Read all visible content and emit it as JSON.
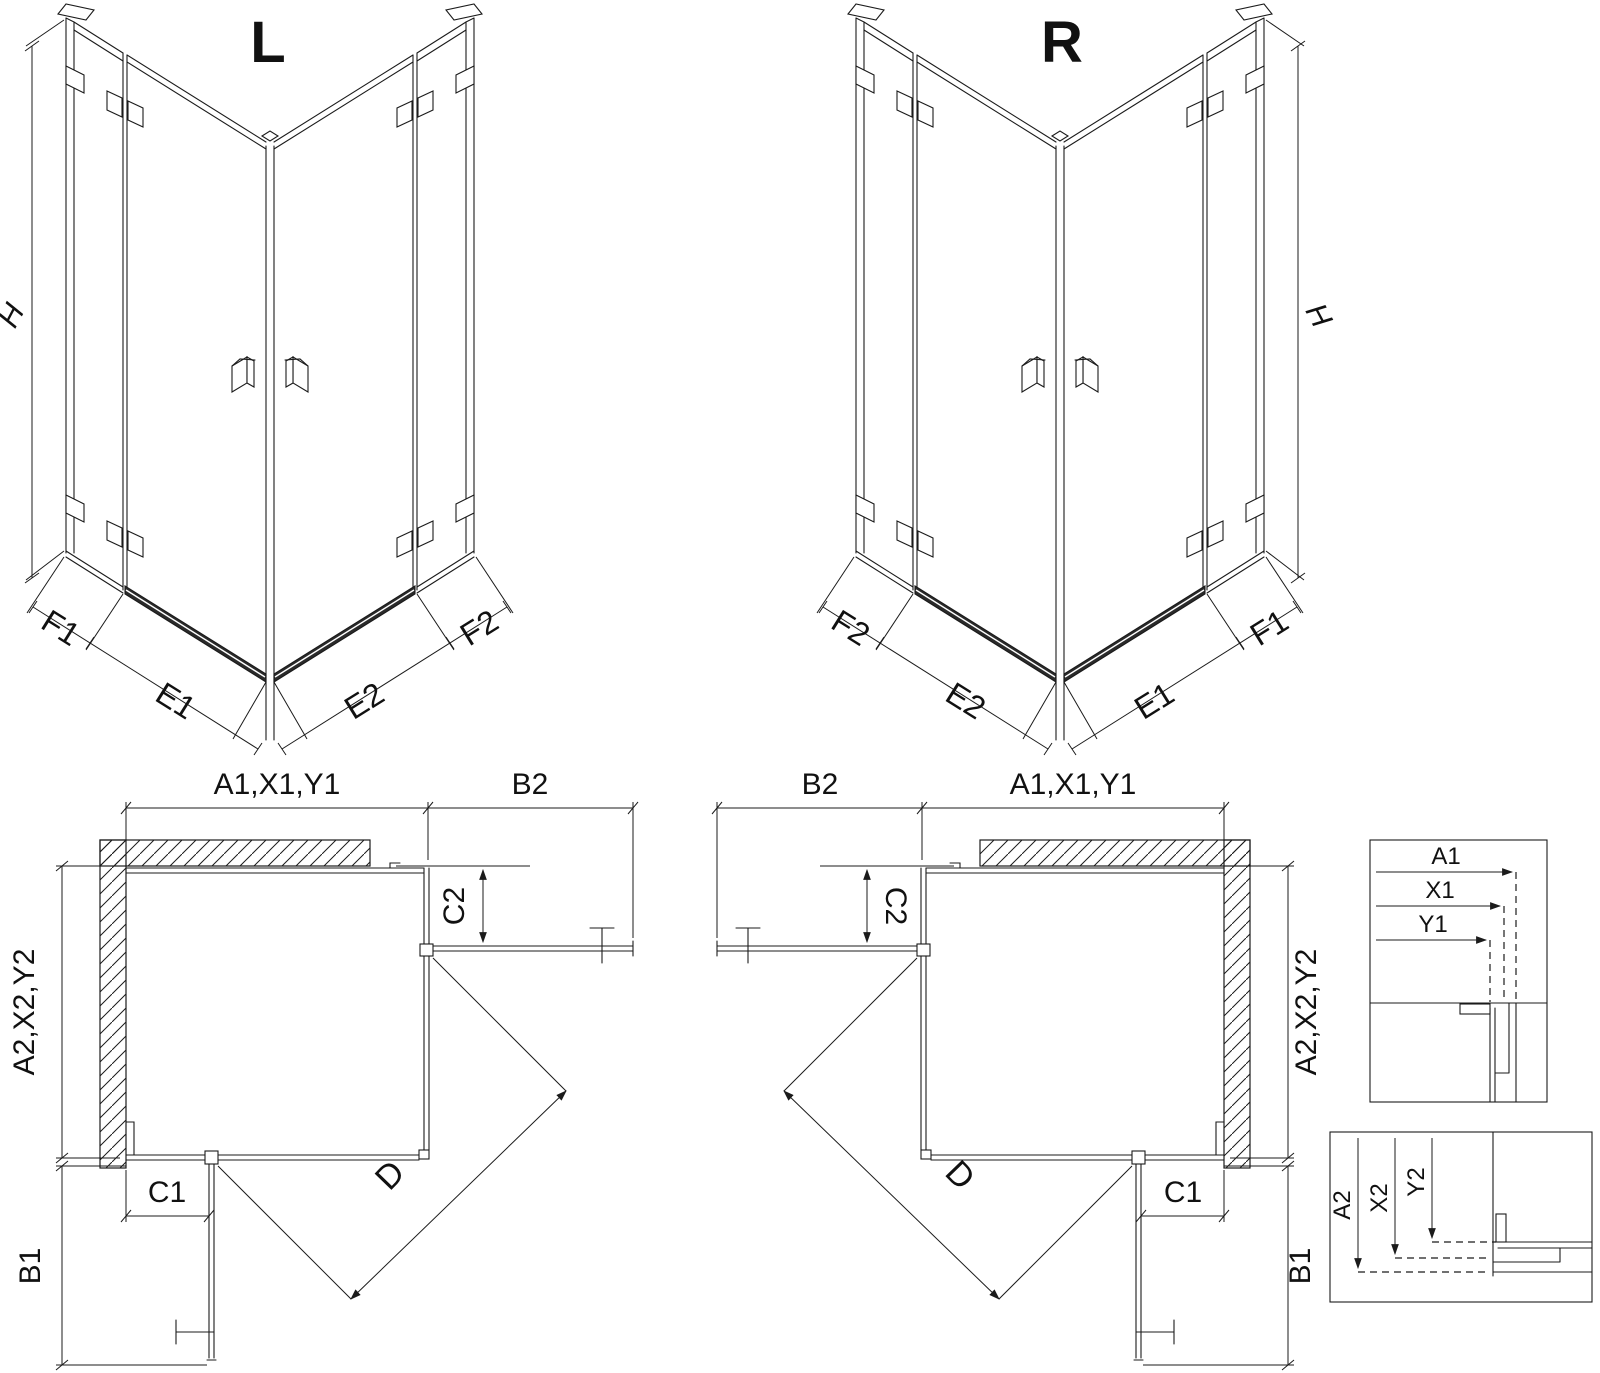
{
  "drawing": {
    "iso_left": {
      "title": "L",
      "dim_h": "H",
      "dims": {
        "f1": "F1",
        "e1": "E1",
        "e2": "E2",
        "f2": "F2"
      }
    },
    "iso_right": {
      "title": "R",
      "dim_h": "H",
      "dims": {
        "f2": "F2",
        "e2": "E2",
        "e1": "E1",
        "f1": "F1"
      }
    },
    "plan_left": {
      "top_width": "A1,X1,Y1",
      "top_side": "B2",
      "left_height": "A2,X2,Y2",
      "left_side": "B1",
      "panel_bottom": "C1",
      "panel_right": "C2",
      "diagonal": "D"
    },
    "plan_right": {
      "top_side": "B2",
      "top_width": "A1,X1,Y1",
      "right_height": "A2,X2,Y2",
      "right_side": "B1",
      "panel_bottom": "C1",
      "panel_left": "C2",
      "diagonal": "D"
    },
    "detail_top": {
      "a1": "A1",
      "x1": "X1",
      "y1": "Y1"
    },
    "detail_bottom": {
      "a2": "A2",
      "x2": "X2",
      "y2": "Y2"
    }
  }
}
